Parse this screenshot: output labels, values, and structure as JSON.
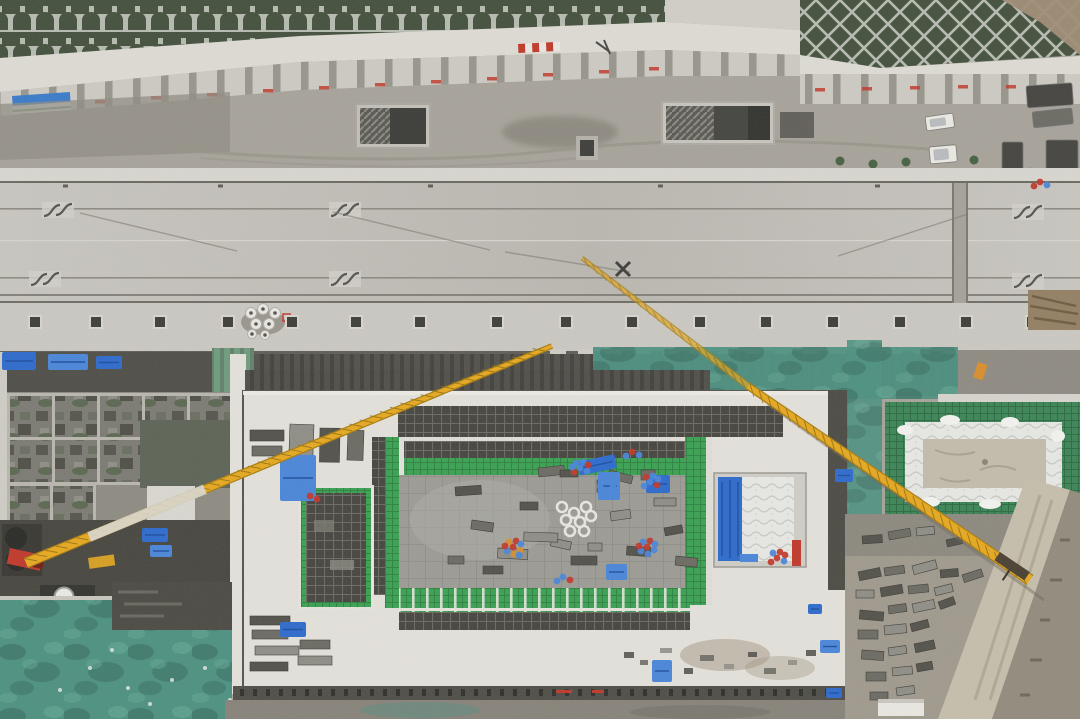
{
  "meta": {
    "subject": "Aerial drone photograph of a construction site: a concrete road deck with pedestrian entrances runs along a green terraced slope; below it a large rectangular station excavation with green safety netting, rebar mats and blue tarps, two yellow tower-crane jibs crossing the site, a secondary pit with white insulation blankets, and material storage yards",
    "width": 1080,
    "height": 719
  },
  "palette": {
    "road": "#c8c6bf",
    "road2": "#bab7b0",
    "sidewalk": "#cac8c1",
    "parapet": "#d8d6cf",
    "gravel": "#a7a39a",
    "gravel_dark": "#908c83",
    "wall": "#dddbd3",
    "slab": "#cccac2",
    "slope_veg": "#44503d",
    "slope_frame": "#b6bbb0",
    "teal": "#4d9181",
    "teal_dark": "#35695d",
    "apron": "#e3e1da",
    "floor": "#9c9b94",
    "rebar": "#46453f",
    "rebar_line": "#6b6a62",
    "net_green": "#3aa152",
    "net_dark": "#2e8340",
    "quilt": "#e7e8e4",
    "sand": "#c3bcab",
    "yard": "#a09a8d",
    "blue": "#2e6bcc",
    "blue2": "#4a86d8",
    "red": "#c0392b",
    "orange": "#d98e2b",
    "crane_yellow": "#e6a81f",
    "crane_dark": "#8a6a10",
    "dark_band": "#52514b",
    "stack_dark": "#53524b",
    "stack_mid": "#6c6b63",
    "stack_light": "#8f8e86",
    "white": "#ebe9e2",
    "truck_dark": "#45443f",
    "banner_blue": "#3a7bc8",
    "dirt": "#a08d76"
  },
  "objects": {
    "road_furniture": {
      "vent_y": 316,
      "vent_size": 12,
      "vents": [
        35,
        96,
        160,
        228,
        292,
        356,
        420,
        497,
        566,
        632,
        700,
        766,
        833,
        900,
        966,
        1032
      ],
      "teeth": {
        "from": 550,
        "to": 1005,
        "step": 28,
        "y": 349,
        "w": 16,
        "h": 11
      },
      "reels": [
        [
          251,
          313
        ],
        [
          263,
          309
        ],
        [
          275,
          313
        ],
        [
          256,
          324
        ],
        [
          269,
          324
        ],
        [
          252,
          334
        ],
        [
          265,
          335
        ]
      ]
    },
    "wall_ticks": {
      "left": [
        [
          95,
          100
        ],
        [
          151,
          96
        ],
        [
          207,
          93
        ],
        [
          263,
          89
        ],
        [
          319,
          86
        ],
        [
          375,
          83
        ],
        [
          431,
          80
        ],
        [
          487,
          77
        ],
        [
          543,
          73
        ],
        [
          599,
          70
        ],
        [
          649,
          67
        ]
      ],
      "right": [
        [
          815,
          88
        ],
        [
          862,
          87
        ],
        [
          910,
          86
        ],
        [
          958,
          85
        ],
        [
          1006,
          85
        ],
        [
          1054,
          84
        ]
      ]
    },
    "vehicles": [
      {
        "name": "white-car",
        "x": 925,
        "y": 117,
        "w": 28,
        "h": 14,
        "rot": -8,
        "fill": "white"
      },
      {
        "name": "white-van",
        "x": 929,
        "y": 147,
        "w": 27,
        "h": 17,
        "rot": -5,
        "fill": "white"
      },
      {
        "name": "dark-truck",
        "x": 1002,
        "y": 142,
        "w": 21,
        "h": 28,
        "rot": 0,
        "fill": "truck_dark"
      },
      {
        "name": "parked-truck",
        "x": 1026,
        "y": 86,
        "w": 46,
        "h": 22,
        "rot": -4,
        "fill": "truck_dark"
      },
      {
        "name": "parked-truck",
        "x": 1032,
        "y": 112,
        "w": 40,
        "h": 16,
        "rot": -6,
        "fill": "stack_mid"
      },
      {
        "name": "parked-truck",
        "x": 1046,
        "y": 140,
        "w": 32,
        "h": 32,
        "rot": 0,
        "fill": "truck_dark"
      },
      {
        "name": "tarped-load",
        "x": 1028,
        "y": 168,
        "w": 30,
        "h": 40,
        "rot": 3,
        "fill": "blue"
      },
      {
        "name": "parked-truck",
        "x": 1020,
        "y": 210,
        "w": 44,
        "h": 24,
        "rot": -2,
        "fill": "truck_dark"
      },
      {
        "name": "parked-truck",
        "x": 1018,
        "y": 244,
        "w": 54,
        "h": 28,
        "rot": -3,
        "fill": "stack_dark"
      }
    ],
    "shrubs": [
      [
        840,
        161
      ],
      [
        873,
        164
      ],
      [
        906,
        162
      ],
      [
        974,
        160
      ]
    ],
    "cranes": [
      {
        "name": "left-crane-jib",
        "pts": [
          [
            26,
            563
          ],
          [
            552,
            346
          ]
        ],
        "w0": 10,
        "w1": 4.5,
        "silver": [
          0.12,
          0.34
        ]
      },
      {
        "name": "right-crane-jib",
        "pts": [
          [
            582,
            258
          ],
          [
            748,
            386
          ],
          [
            1030,
            580
          ]
        ],
        "w0": 3.5,
        "w1": 11
      }
    ],
    "pit_stacks": [
      [
        455,
        487,
        26,
        9,
        -4
      ],
      [
        472,
        520,
        22,
        9,
        8
      ],
      [
        498,
        548,
        30,
        10,
        3
      ],
      [
        520,
        502,
        18,
        8,
        0
      ],
      [
        538,
        468,
        26,
        9,
        -6
      ],
      [
        552,
        538,
        20,
        8,
        12
      ],
      [
        571,
        556,
        26,
        9,
        0
      ],
      [
        597,
        480,
        16,
        12,
        0
      ],
      [
        610,
        512,
        20,
        9,
        -8
      ],
      [
        627,
        546,
        24,
        9,
        4
      ],
      [
        641,
        470,
        14,
        10,
        0
      ],
      [
        654,
        498,
        22,
        8,
        0
      ],
      [
        664,
        528,
        18,
        8,
        -10
      ],
      [
        676,
        556,
        22,
        9,
        6
      ],
      [
        524,
        532,
        34,
        9,
        2
      ],
      [
        483,
        566,
        20,
        8,
        0
      ],
      [
        448,
        556,
        16,
        8,
        0
      ],
      [
        588,
        543,
        14,
        8,
        0
      ],
      [
        560,
        470,
        18,
        7,
        0
      ],
      [
        610,
        470,
        24,
        8,
        15
      ]
    ],
    "yard_stacks": [
      [
        858,
        572,
        22,
        9,
        -12
      ],
      [
        884,
        568,
        20,
        8,
        -8
      ],
      [
        912,
        566,
        24,
        9,
        -15
      ],
      [
        940,
        570,
        18,
        8,
        -5
      ],
      [
        962,
        575,
        20,
        8,
        -18
      ],
      [
        856,
        590,
        18,
        8,
        0
      ],
      [
        880,
        588,
        22,
        9,
        -10
      ],
      [
        908,
        586,
        20,
        8,
        -6
      ],
      [
        934,
        588,
        18,
        8,
        -14
      ],
      [
        860,
        610,
        24,
        9,
        5
      ],
      [
        888,
        606,
        18,
        8,
        -8
      ],
      [
        912,
        604,
        22,
        9,
        -12
      ],
      [
        938,
        602,
        16,
        8,
        -20
      ],
      [
        858,
        630,
        20,
        9,
        0
      ],
      [
        884,
        626,
        22,
        9,
        -6
      ],
      [
        910,
        624,
        18,
        8,
        -15
      ],
      [
        862,
        650,
        22,
        9,
        4
      ],
      [
        888,
        648,
        18,
        8,
        -8
      ],
      [
        914,
        644,
        20,
        9,
        -12
      ],
      [
        866,
        672,
        20,
        9,
        0
      ],
      [
        892,
        668,
        20,
        8,
        -6
      ],
      [
        916,
        664,
        16,
        8,
        -10
      ],
      [
        870,
        692,
        18,
        8,
        0
      ],
      [
        896,
        688,
        18,
        8,
        -8
      ],
      [
        862,
        536,
        20,
        8,
        -4
      ],
      [
        888,
        532,
        22,
        8,
        -10
      ],
      [
        916,
        528,
        18,
        8,
        -6
      ],
      [
        946,
        540,
        16,
        7,
        -12
      ]
    ],
    "left_stacks": [
      [
        250,
        616,
        40,
        9,
        0
      ],
      [
        252,
        630,
        36,
        9,
        0
      ],
      [
        255,
        646,
        44,
        9,
        0
      ],
      [
        250,
        662,
        38,
        9,
        0
      ],
      [
        300,
        640,
        30,
        9,
        0
      ],
      [
        298,
        656,
        34,
        9,
        0
      ],
      [
        250,
        430,
        34,
        11,
        0
      ],
      [
        252,
        446,
        30,
        10,
        0
      ],
      [
        290,
        424,
        24,
        36,
        2
      ],
      [
        320,
        428,
        20,
        34,
        1
      ],
      [
        348,
        430,
        16,
        30,
        2
      ]
    ],
    "debris": [
      [
        624,
        652,
        10,
        6
      ],
      [
        640,
        660,
        8,
        5
      ],
      [
        660,
        648,
        12,
        5
      ],
      [
        684,
        668,
        9,
        6
      ],
      [
        700,
        655,
        14,
        6
      ],
      [
        724,
        664,
        10,
        5
      ],
      [
        748,
        652,
        9,
        5
      ],
      [
        764,
        668,
        12,
        6
      ],
      [
        788,
        660,
        9,
        5
      ],
      [
        806,
        650,
        10,
        6
      ]
    ],
    "blue_tarps": [
      [
        2,
        352,
        34,
        18,
        0
      ],
      [
        48,
        354,
        40,
        16,
        0
      ],
      [
        96,
        356,
        26,
        13,
        0
      ],
      [
        280,
        455,
        36,
        46,
        0
      ],
      [
        577,
        462,
        38,
        14,
        -12
      ],
      [
        598,
        472,
        22,
        28,
        0
      ],
      [
        646,
        475,
        24,
        18,
        0
      ],
      [
        606,
        564,
        21,
        16,
        0
      ],
      [
        142,
        528,
        26,
        14,
        0
      ],
      [
        150,
        545,
        22,
        12,
        0
      ],
      [
        835,
        469,
        18,
        13,
        0
      ],
      [
        876,
        616,
        13,
        9,
        0
      ],
      [
        808,
        604,
        14,
        10,
        0
      ],
      [
        820,
        640,
        20,
        13,
        0
      ],
      [
        826,
        688,
        16,
        10,
        0
      ],
      [
        652,
        660,
        20,
        22,
        0
      ],
      [
        280,
        622,
        26,
        15,
        0
      ]
    ],
    "clusters": [
      [
        513,
        547,
        9,
        "rob"
      ],
      [
        647,
        547,
        8,
        "rbb"
      ],
      [
        580,
        468,
        7,
        "bbr"
      ],
      [
        650,
        482,
        6,
        "brb"
      ],
      [
        606,
        482,
        5,
        "bbb"
      ],
      [
        777,
        558,
        6,
        "rbr"
      ],
      [
        632,
        452,
        3,
        "rbb"
      ],
      [
        310,
        496,
        2,
        "rr"
      ],
      [
        1040,
        182,
        3,
        "rbr"
      ],
      [
        563,
        577,
        3,
        "br"
      ]
    ],
    "coils": [
      [
        562,
        507
      ],
      [
        574,
        513
      ],
      [
        586,
        507
      ],
      [
        566,
        520
      ],
      [
        580,
        522
      ],
      [
        591,
        516
      ],
      [
        570,
        531
      ],
      [
        584,
        531
      ]
    ],
    "specks": [
      [
        128,
        688
      ],
      [
        172,
        680
      ],
      [
        150,
        704
      ],
      [
        205,
        668
      ],
      [
        90,
        668
      ],
      [
        60,
        690
      ],
      [
        230,
        700
      ],
      [
        112,
        650
      ]
    ],
    "red_dashes": [
      [
        556,
        690,
        16,
        3
      ],
      [
        592,
        690,
        12,
        3
      ]
    ],
    "posts": {
      "from": 240,
      "to": 848,
      "step": 13,
      "y": 689
    }
  }
}
